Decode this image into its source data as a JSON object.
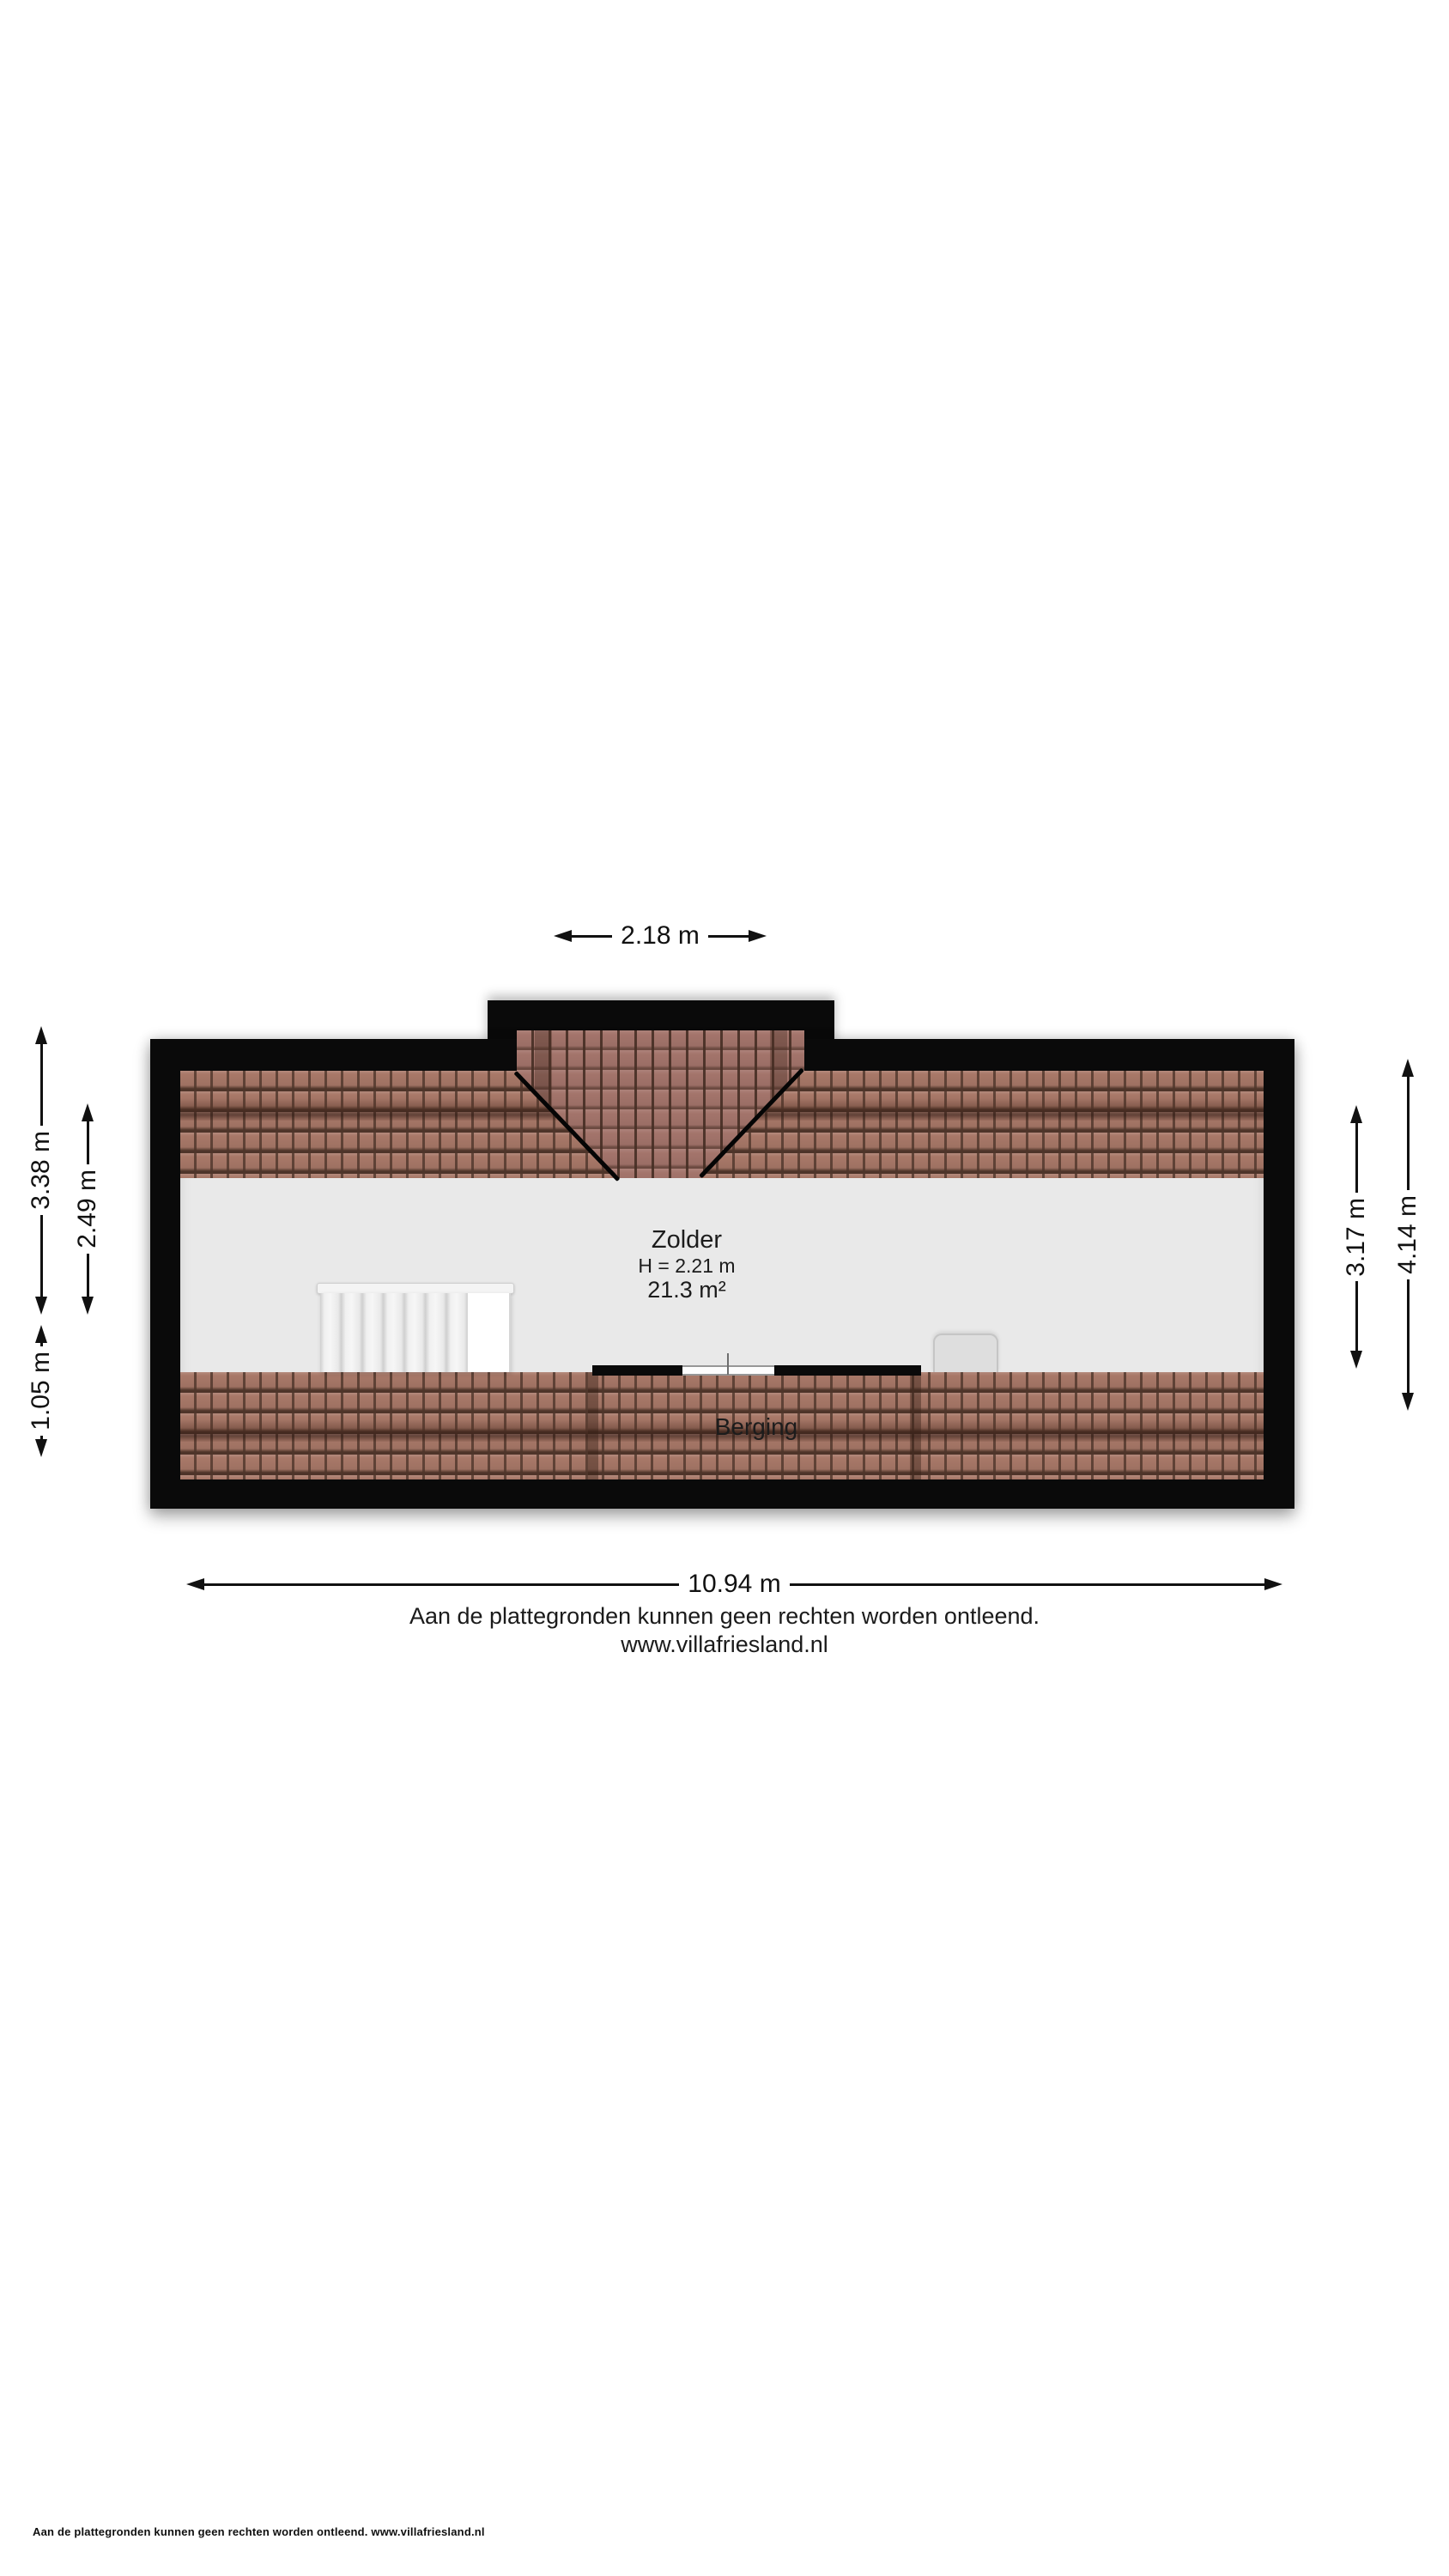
{
  "floorplan": {
    "rooms": [
      {
        "name": "Zolder",
        "height_label": "H = 2.21 m",
        "area_label": "21.3 m²"
      },
      {
        "name": "Berging"
      }
    ],
    "dimensions": {
      "top": "2.18 m",
      "left_outer": "3.38 m",
      "left_inner": "2.49 m",
      "left_lower": "1.05 m",
      "right_inner": "3.17 m",
      "right_outer": "4.14 m",
      "bottom": "10.94 m"
    },
    "colors": {
      "wall": "#0a0a0a",
      "floor": "#e9e9e9",
      "tile_base": "#a87868",
      "tile_line": "#4e352a",
      "page_bg": "#ffffff",
      "dim_color": "#111111"
    }
  },
  "disclaimer": {
    "line1": "Aan de plattegronden kunnen geen rechten worden ontleend.",
    "line2": "www.villafriesland.nl"
  },
  "footer": {
    "text": "Aan de plattegronden kunnen geen rechten worden ontleend. www.villafriesland.nl"
  }
}
